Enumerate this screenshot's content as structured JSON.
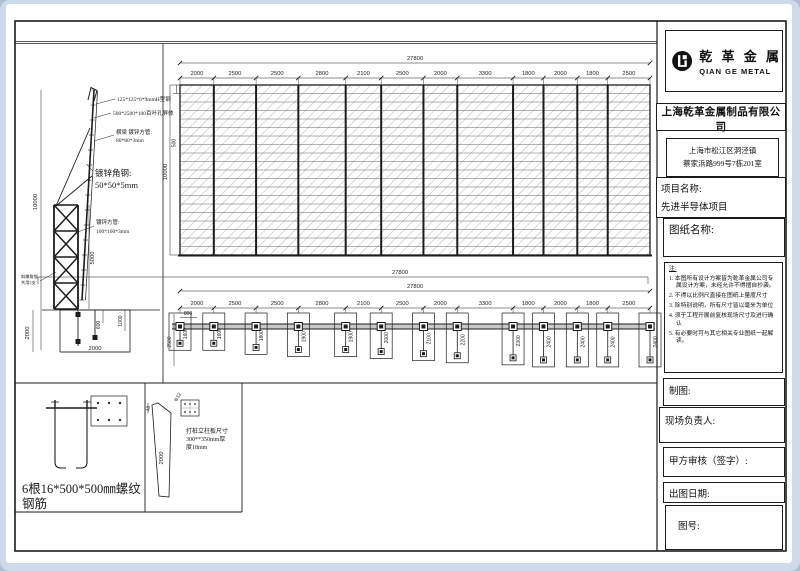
{
  "colors": {
    "backdrop": "#ccdaea",
    "sheet": "#ffffff",
    "line": "#1c1c1c",
    "hatch": "#8f8f8f",
    "wall_fill": "#c8c8c8"
  },
  "logo": {
    "cn": "乾 革 金 属",
    "en": "QIAN GE METAL",
    "mark": "qiange-monogram"
  },
  "title_block": {
    "company": "上海乾革金属制品有限公司",
    "address1": "上海市松江区洞泾镇",
    "address2": "蔡家浜路999号7栋201室",
    "project_label": "项目名称:",
    "project_value": "先进半导体项目",
    "drawing_label": "图纸名称:",
    "notes_label": "注:",
    "notes": [
      "1. 本图所有设计方案皆为乾革金属公司专属设计方案，未经允许不得擅自抄袭。",
      "2. 不得以比例尺直接在图纸上量度尺寸",
      "3. 除特别说明，所有尺寸皆以毫米为单位",
      "4. 须于工程开展前复核现场尺寸及进行确认",
      "5. 有必要时可与其它相关专业图纸一起解读。"
    ],
    "maker_label": "制图:",
    "site_label": "现场负责人:",
    "review_label": "甲方审核（签字）:",
    "date_label": "出图日期:",
    "number_label": "图号:"
  },
  "elevation": {
    "total_dim": "27800",
    "segments": [
      "2000",
      "2500",
      "2500",
      "2800",
      "2100",
      "2500",
      "2000",
      "3300",
      "1800",
      "2000",
      "1800",
      "2500"
    ],
    "height_dim": "10000",
    "band_dim": "500",
    "rows": 20
  },
  "plan": {
    "overall_dim": "27800",
    "total_dim": "27800",
    "segments": [
      "2000",
      "2500",
      "2500",
      "2800",
      "2100",
      "2500",
      "2000",
      "3300",
      "1800",
      "2000",
      "1800",
      "2500"
    ],
    "post_depths": [
      "1600",
      "1600",
      "1800",
      "1900",
      "1900",
      "2000",
      "2100",
      "2200",
      "2300",
      "2400",
      "2400",
      "2400",
      "2400"
    ],
    "first_outer_dim": "2500",
    "start_dim": "800"
  },
  "detail": {
    "ann_h_steel": "125*125*6*9mmH型钢",
    "ann_panel": "500*2500*100百叶孔屏体",
    "ann_beam1": "横梁 镀锌方管:",
    "ann_beam2": "80*80*3mm",
    "ann_angle1": "镀锌角钢:",
    "ann_angle2": "50*50*5mm",
    "ann_tube1": "镀锌方管:",
    "ann_tube2": "100*100*3mm",
    "side_note1": "斜撑角钢",
    "side_note2": "共用5支",
    "dim_height": "10000",
    "dim_truss": "5000",
    "dim_bury": "2000",
    "dim_600": "600",
    "dim_1000": "1000",
    "dim_base": "2000"
  },
  "footer": {
    "rebar_line1": "6根16*500*500㎜螺纹",
    "rebar_line2": "钢筋",
    "pile_dim_18": "18",
    "pile_dim_2000": "2000",
    "pile_phi": "Φ12",
    "pile_text1": "打桩立柱板尺寸",
    "pile_text2": "300**350mm厚",
    "pile_text3": "度18mm"
  }
}
